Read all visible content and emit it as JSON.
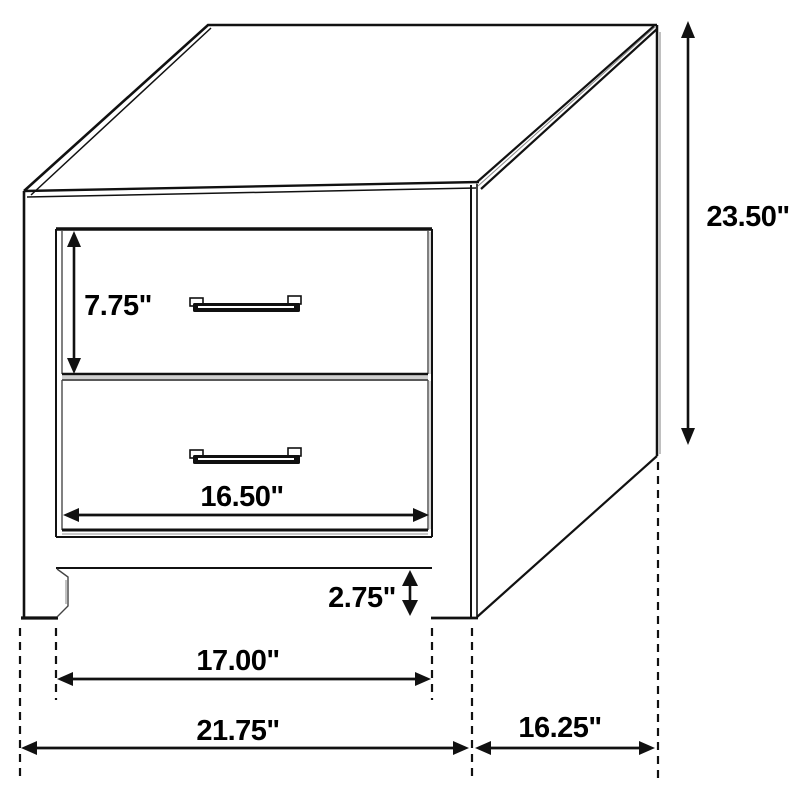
{
  "diagram": {
    "colors": {
      "line": "#000000",
      "background": "#ffffff",
      "shadow": "#aaaaaa"
    },
    "dimensions": {
      "drawer_height": "7.75\"",
      "drawer_width": "16.50\"",
      "overall_height": "23.50\"",
      "base_height": "2.75\"",
      "leg_spacing": "17.00\"",
      "overall_width": "21.75\"",
      "overall_depth": "16.25\""
    }
  }
}
